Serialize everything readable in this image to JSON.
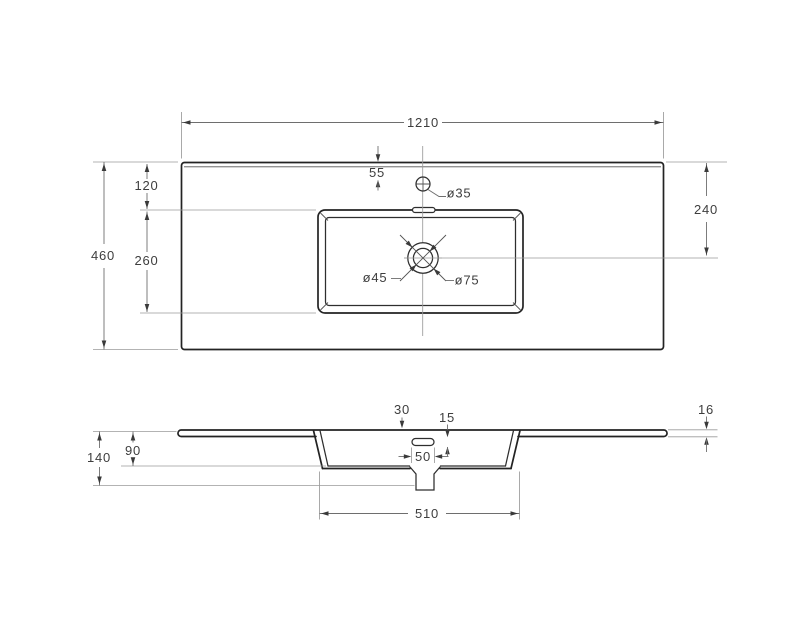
{
  "drawing": {
    "type_note": "sink countertop technical drawing, two orthographic views",
    "labels": {
      "overall_width": "1210",
      "overall_depth": "460",
      "basin_offset_top": "120",
      "basin_cutout_depth": "260",
      "faucet_offset": "55",
      "faucet_hole_dia": "ø35",
      "drain_hole_dia": "ø45",
      "drain_recess_dia": "ø75",
      "drain_offset_top": "240",
      "rim_width": "30",
      "overflow_slot_height": "15",
      "overflow_slot_width": "50",
      "basin_width": "510",
      "edge_thickness": "16",
      "total_height": "140",
      "basin_inner_depth": "90"
    },
    "colors": {
      "background": "#ffffff",
      "outline": "#232323",
      "dimension_line": "#6e6e6e",
      "extension_line": "#9a9a9a",
      "text": "#3e3e3e"
    }
  }
}
